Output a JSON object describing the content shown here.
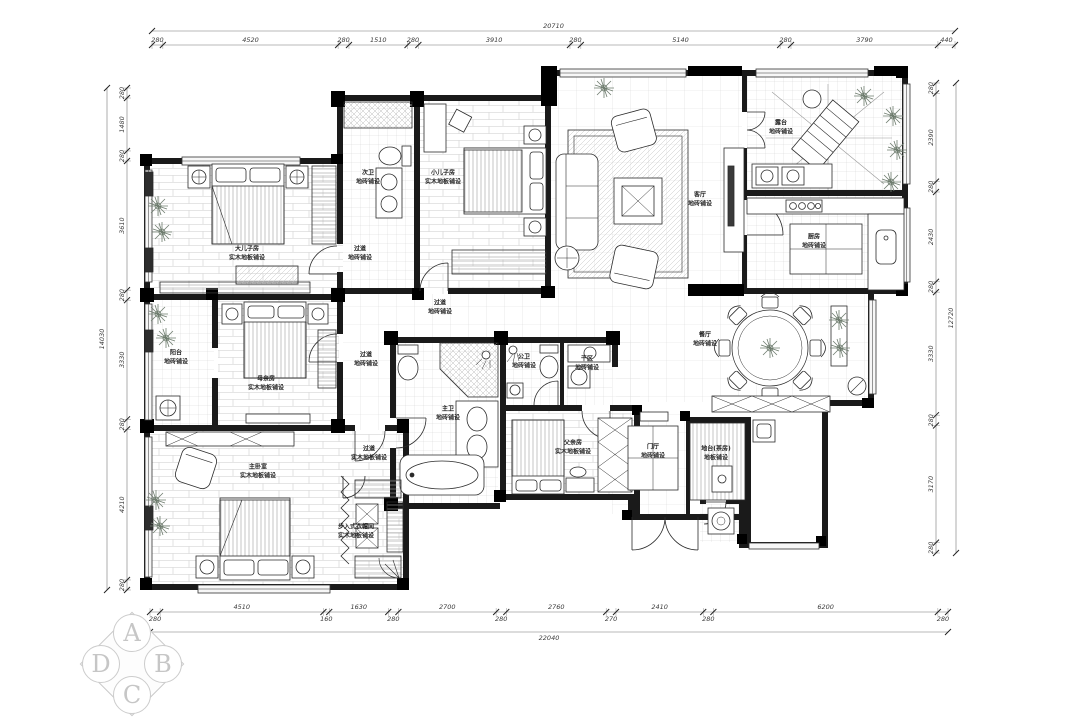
{
  "meta": {
    "background": "#ffffff",
    "line_color": "#1a1a1a",
    "grid_color": "#d6d6d6",
    "dim_color": "#3a3a3a",
    "logo_color": "#c6c6c6"
  },
  "dimensions": {
    "top": {
      "total": "20710",
      "segments": [
        "280",
        "4520",
        "280",
        "1510",
        "280",
        "3910",
        "280",
        "5140",
        "280",
        "3790",
        "440"
      ]
    },
    "bottom": {
      "total": "22040",
      "segments": [
        "280",
        "4510",
        "160",
        "1630",
        "280",
        "2700",
        "280",
        "2760",
        "270",
        "2410",
        "280",
        "6200",
        "280"
      ]
    },
    "left": {
      "total": "14030",
      "segments": [
        "280",
        "1480",
        "280",
        "3610",
        "280",
        "3330",
        "280",
        "4210",
        "280"
      ]
    },
    "right": {
      "total": "12720",
      "segments": [
        "280",
        "2390",
        "280",
        "2430",
        "280",
        "3330",
        "280",
        "3170",
        "280"
      ]
    }
  },
  "rooms": [
    {
      "name": "大儿子房",
      "material": "实木地板铺设",
      "x": 247,
      "y": 254
    },
    {
      "name": "次卫",
      "material": "地砖铺设",
      "x": 368,
      "y": 178
    },
    {
      "name": "小儿子房",
      "material": "实木地板铺设",
      "x": 443,
      "y": 178
    },
    {
      "name": "过道",
      "material": "地砖铺设",
      "x": 360,
      "y": 254
    },
    {
      "name": "客厅",
      "material": "地砖铺设",
      "x": 700,
      "y": 200
    },
    {
      "name": "露台",
      "material": "地砖铺设",
      "x": 781,
      "y": 128
    },
    {
      "name": "厨房",
      "material": "地砖铺设",
      "x": 814,
      "y": 242
    },
    {
      "name": "餐厅",
      "material": "地砖铺设",
      "x": 705,
      "y": 340
    },
    {
      "name": "过道",
      "material": "地砖铺设",
      "x": 440,
      "y": 308
    },
    {
      "name": "过道",
      "material": "地砖铺设",
      "x": 366,
      "y": 360
    },
    {
      "name": "阳台",
      "material": "地砖铺设",
      "x": 176,
      "y": 358
    },
    {
      "name": "母亲房",
      "material": "实木地板铺设",
      "x": 266,
      "y": 384
    },
    {
      "name": "主卫",
      "material": "地砖铺设",
      "x": 448,
      "y": 414
    },
    {
      "name": "公卫",
      "material": "地砖铺设",
      "x": 524,
      "y": 362
    },
    {
      "name": "干区",
      "material": "地砖铺设",
      "x": 587,
      "y": 364
    },
    {
      "name": "父亲房",
      "material": "实木地板铺设",
      "x": 573,
      "y": 448
    },
    {
      "name": "门厅",
      "material": "地砖铺设",
      "x": 653,
      "y": 452
    },
    {
      "name": "地台(茶房)",
      "material": "地板铺设",
      "x": 716,
      "y": 454
    },
    {
      "name": "过道",
      "material": "实木地板铺设",
      "x": 369,
      "y": 454
    },
    {
      "name": "主卧室",
      "material": "实木地板铺设",
      "x": 258,
      "y": 472
    },
    {
      "name": "步入式衣帽间",
      "material": "实木地板铺设",
      "x": 356,
      "y": 532
    }
  ],
  "logo": {
    "letters": [
      "A",
      "B",
      "C",
      "D"
    ]
  }
}
